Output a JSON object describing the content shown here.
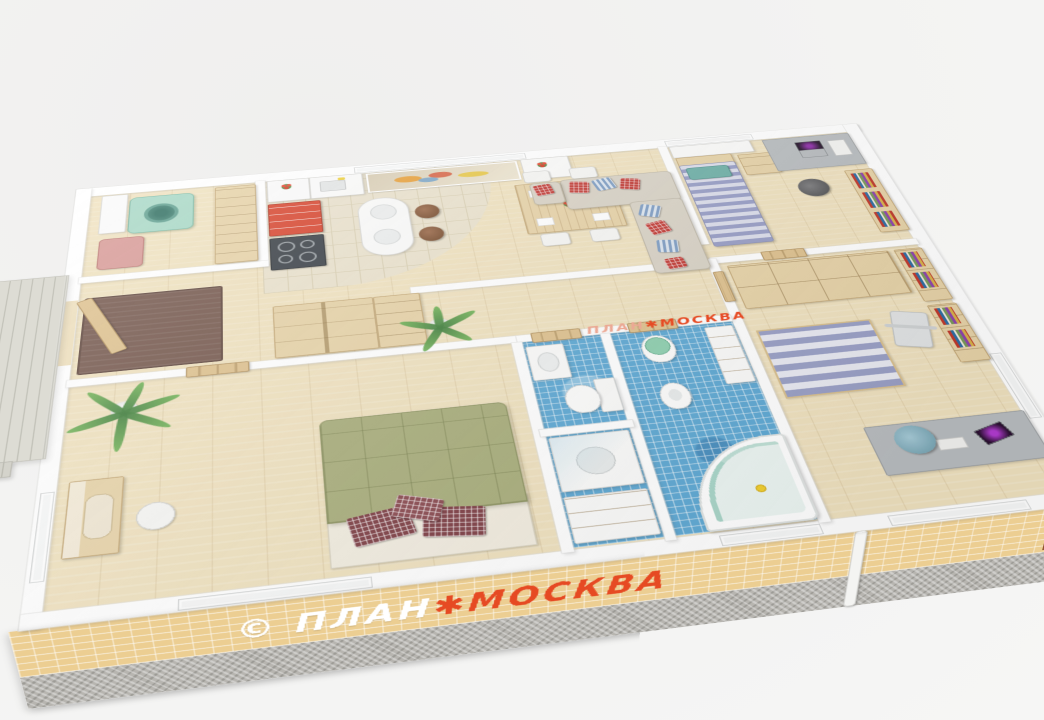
{
  "title": "3D isometric floor plan render",
  "background": "#f2f2f1",
  "watermarks": {
    "front_wall": {
      "copyright": "©",
      "plan": " ПЛАН",
      "star": "✱",
      "moskva": "МОСКВА",
      "plan_color": "#ffffff",
      "moskva_color": "#e64a23"
    },
    "floor": {
      "plan": "ПЛАН",
      "star": "✱",
      "moskva": "МОСКВА",
      "plan_color": "#eba894",
      "moskva_color": "#e2432c"
    }
  },
  "palette": {
    "background": "#f2f2f1",
    "wall_white": "#ffffff",
    "brick": "#ecce92",
    "stone_base": "#b7b5b0",
    "wood_floor": "#f0e2bf",
    "kitchen_tile": "#eae2cd",
    "bath_tile": "#5fa9d4",
    "wood_furniture": "#e7d3a8",
    "accent_red": "#d8452e",
    "sofa_beige": "#d9d3c6",
    "bed_green": "#a9ae7c",
    "pillow_dark_red": "#c23b35",
    "bed_blue_stripe": "#989ec6",
    "washer_teal": "#a8d8c6",
    "entry_mat_brown": "#75584d",
    "deck_gray": "#dddcd4",
    "duck_yellow": "#f2cf2e"
  },
  "scene": {
    "view": "cutaway axonometric from above",
    "deck_steps": 4,
    "rooms": [
      {
        "name": "laundry-room",
        "furniture": [
          "washing-machine",
          "laundry-basket",
          "counter",
          "wall-cabinets"
        ]
      },
      {
        "name": "kitchen",
        "furniture": [
          "cooktop",
          "red-drawer-cabinet",
          "sink-cabinet",
          "flower-vase",
          "wall-art",
          "bar-counter",
          "bar-stool",
          "bar-stool"
        ]
      },
      {
        "name": "dining-living-room",
        "furniture": [
          "dining-table",
          "dining-chairs",
          "table-flowers",
          "corner-sofa",
          "ottoman",
          "throw-pillows"
        ]
      },
      {
        "name": "bedroom-top-right",
        "furniture": [
          "single-bed-blue",
          "nightstand",
          "desk-with-laptop",
          "office-chair",
          "bookshelf",
          "window-cabinets"
        ]
      },
      {
        "name": "study",
        "furniture": [
          "wardrobe-cubbies",
          "bookshelves",
          "striped-rug",
          "desk-with-monitor",
          "blue-office-chair",
          "exercise-machine"
        ]
      },
      {
        "name": "hallway",
        "furniture": [
          "hall-wardrobe",
          "open-shelf-unit",
          "entry-mat",
          "palm-plant",
          "interior-doors"
        ]
      },
      {
        "name": "master-bedroom",
        "furniture": [
          "double-bed-green",
          "red-pillows",
          "palm-plant",
          "dressing-table",
          "vanity-chair"
        ]
      },
      {
        "name": "wc",
        "furniture": [
          "washbasin",
          "toilet"
        ]
      },
      {
        "name": "shower-room",
        "furniture": [
          "shower-tray",
          "vanity-cabinet"
        ]
      },
      {
        "name": "bathroom",
        "furniture": [
          "toilet-green-lid",
          "bidet",
          "corner-bathtub",
          "rubber-duck",
          "storage-cabinet"
        ]
      },
      {
        "name": "porch-deck",
        "furniture": [
          "wood-planks",
          "steps"
        ]
      }
    ]
  }
}
